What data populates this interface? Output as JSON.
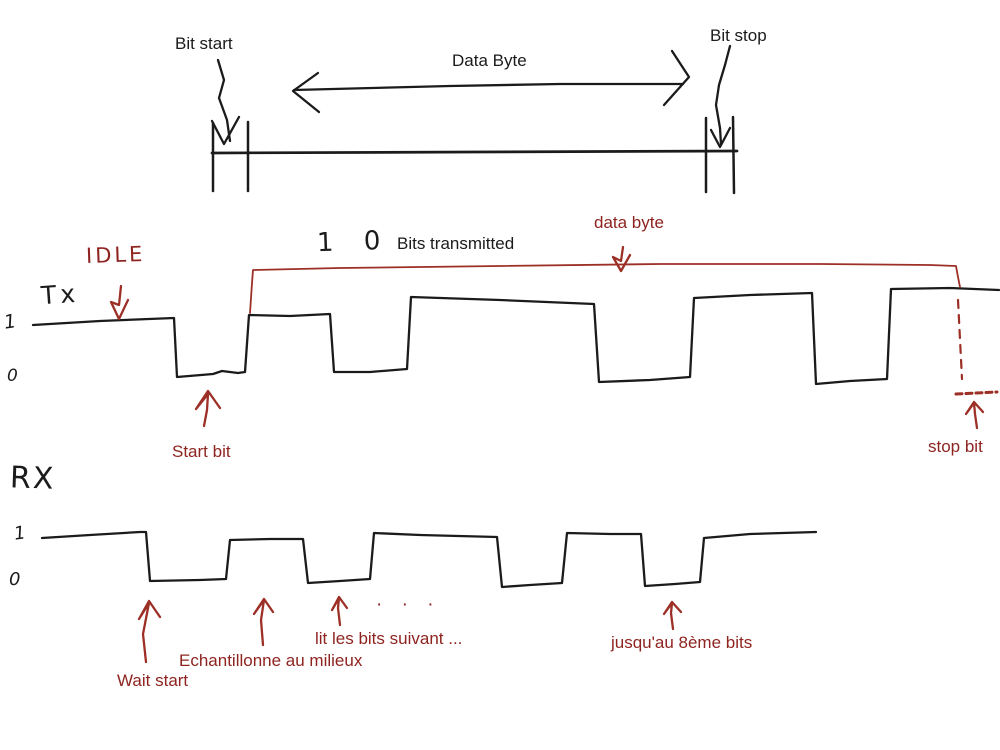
{
  "colors": {
    "background": "#ffffff",
    "ink": "#1b1b1b",
    "red_text": "#8e2420",
    "red_stroke": "#9c2f26"
  },
  "top_timeline": {
    "bit_start": "Bit start",
    "data_byte": "Data Byte",
    "bit_stop": "Bit stop"
  },
  "tx": {
    "idle": "IDLE",
    "label": "Tx",
    "level_high": "1",
    "level_low": "0",
    "bits_handwritten": "1 0",
    "bits_transmitted": "Bits transmitted",
    "data_byte": "data byte",
    "start_bit": "Start bit",
    "stop_bit": "stop bit"
  },
  "rx": {
    "label": "RX",
    "level_high": "1",
    "level_low": "0",
    "dots": "· · ·",
    "wait_start": "Wait start",
    "sample_middle": "Echantillonne au milieux",
    "read_next": "lit les bits suivant ...",
    "until_eighth": "jusqu'au 8ème bits"
  },
  "strokes": {
    "timeline": [
      [
        212,
        153
      ],
      [
        470,
        152
      ],
      [
        737,
        151
      ]
    ],
    "tick_left_outer": [
      [
        213,
        123
      ],
      [
        213,
        191
      ]
    ],
    "tick_left_inner": [
      [
        248,
        122
      ],
      [
        248,
        191
      ]
    ],
    "tick_right_inner": [
      [
        706,
        118
      ],
      [
        706,
        192
      ]
    ],
    "tick_right_outer": [
      [
        733,
        117
      ],
      [
        734,
        193
      ]
    ],
    "bit_start_arrow_tail": [
      [
        218,
        60
      ],
      [
        224,
        80
      ],
      [
        219,
        98
      ],
      [
        227,
        120
      ],
      [
        230,
        141
      ]
    ],
    "bit_start_arrow_head": [
      [
        212,
        121
      ],
      [
        224,
        144
      ],
      [
        239,
        117
      ]
    ],
    "bit_stop_arrow_tail": [
      [
        730,
        46
      ],
      [
        725,
        65
      ],
      [
        719,
        85
      ],
      [
        716,
        105
      ],
      [
        720,
        128
      ],
      [
        721,
        144
      ]
    ],
    "bit_stop_arrow_head": [
      [
        711,
        130
      ],
      [
        720,
        147
      ],
      [
        730,
        128
      ]
    ],
    "span_arrow_line": [
      [
        294,
        90
      ],
      [
        450,
        86
      ],
      [
        560,
        84
      ],
      [
        683,
        84
      ]
    ],
    "span_arrow_head_left": [
      [
        318,
        73
      ],
      [
        293,
        91
      ],
      [
        319,
        112
      ]
    ],
    "span_arrow_head_right": [
      [
        672,
        51
      ],
      [
        689,
        77
      ],
      [
        664,
        105
      ]
    ],
    "tx_wave": [
      [
        33,
        325
      ],
      [
        100,
        321
      ],
      [
        174,
        318
      ],
      [
        177,
        377
      ],
      [
        213,
        374
      ],
      [
        222,
        371
      ],
      [
        238,
        373
      ],
      [
        245,
        372
      ],
      [
        249,
        315
      ],
      [
        290,
        316
      ],
      [
        330,
        314
      ],
      [
        334,
        372
      ],
      [
        370,
        372
      ],
      [
        407,
        369
      ],
      [
        411,
        297
      ],
      [
        500,
        300
      ],
      [
        594,
        304
      ],
      [
        599,
        382
      ],
      [
        650,
        380
      ],
      [
        690,
        377
      ],
      [
        694,
        298
      ],
      [
        750,
        295
      ],
      [
        812,
        293
      ],
      [
        816,
        384
      ],
      [
        850,
        381
      ],
      [
        887,
        379
      ],
      [
        891,
        289
      ],
      [
        950,
        288
      ],
      [
        999,
        290
      ]
    ],
    "data_byte_bracket": [
      [
        250,
        313
      ],
      [
        252,
        283
      ],
      [
        253,
        270
      ],
      [
        340,
        268
      ],
      [
        500,
        266
      ],
      [
        660,
        264
      ],
      [
        820,
        264
      ],
      [
        930,
        265
      ],
      [
        956,
        266
      ],
      [
        958,
        277
      ],
      [
        960,
        287
      ]
    ],
    "stop_bit_dash_vertical": [
      [
        958,
        300
      ],
      [
        962,
        379
      ]
    ],
    "stop_bit_dash_horizontal": [
      [
        956,
        394
      ],
      [
        997,
        392
      ]
    ],
    "idle_arrow": [
      [
        121,
        286
      ],
      [
        119,
        305
      ],
      [
        111,
        302
      ],
      [
        119,
        319
      ],
      [
        128,
        300
      ]
    ],
    "data_byte_arrow": [
      [
        623,
        247
      ],
      [
        621,
        261
      ],
      [
        613,
        257
      ],
      [
        621,
        271
      ],
      [
        630,
        255
      ]
    ],
    "start_bit_arrow": [
      [
        204,
        426
      ],
      [
        207,
        410
      ],
      [
        208,
        394
      ],
      [
        196,
        409
      ],
      [
        208,
        391
      ],
      [
        220,
        408
      ]
    ],
    "stop_bit_arrow": [
      [
        977,
        428
      ],
      [
        975,
        414
      ],
      [
        974,
        403
      ],
      [
        966,
        414
      ],
      [
        974,
        402
      ],
      [
        983,
        412
      ]
    ],
    "wait_start_arrow": [
      [
        146,
        662
      ],
      [
        143,
        634
      ],
      [
        149,
        603
      ],
      [
        139,
        619
      ],
      [
        149,
        601
      ],
      [
        160,
        617
      ]
    ],
    "sample_middle_arrow": [
      [
        263,
        645
      ],
      [
        261,
        620
      ],
      [
        264,
        600
      ],
      [
        254,
        614
      ],
      [
        264,
        599
      ],
      [
        273,
        612
      ]
    ],
    "read_next_arrow": [
      [
        340,
        625
      ],
      [
        338,
        608
      ],
      [
        339,
        598
      ],
      [
        332,
        610
      ],
      [
        339,
        597
      ],
      [
        347,
        608
      ]
    ],
    "until_eighth_arrow": [
      [
        673,
        629
      ],
      [
        671,
        613
      ],
      [
        672,
        603
      ],
      [
        664,
        614
      ],
      [
        672,
        602
      ],
      [
        681,
        612
      ]
    ],
    "rx_wave": [
      [
        42,
        538
      ],
      [
        90,
        535
      ],
      [
        140,
        532
      ],
      [
        146,
        532
      ],
      [
        150,
        581
      ],
      [
        200,
        580
      ],
      [
        226,
        579
      ],
      [
        230,
        540
      ],
      [
        270,
        539
      ],
      [
        303,
        539
      ],
      [
        308,
        583
      ],
      [
        340,
        581
      ],
      [
        370,
        579
      ],
      [
        374,
        533
      ],
      [
        420,
        535
      ],
      [
        497,
        537
      ],
      [
        502,
        587
      ],
      [
        530,
        585
      ],
      [
        562,
        583
      ],
      [
        567,
        533
      ],
      [
        610,
        534
      ],
      [
        641,
        534
      ],
      [
        645,
        586
      ],
      [
        675,
        584
      ],
      [
        700,
        582
      ],
      [
        704,
        538
      ],
      [
        750,
        534
      ],
      [
        816,
        532
      ]
    ]
  }
}
